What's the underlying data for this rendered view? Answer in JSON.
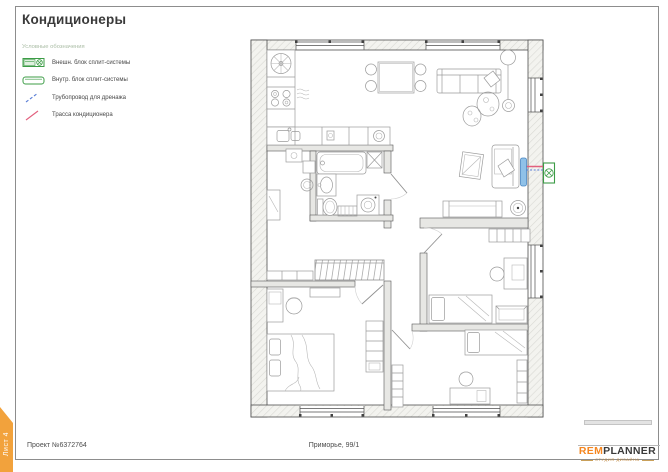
{
  "sheet": {
    "title": "Кондиционеры",
    "tab_label": "Лист 4",
    "footer": {
      "project": "Проект №6372764",
      "address": "Приморье, 99/1"
    },
    "logo": {
      "part1": "REM",
      "part2": "PLANNER",
      "subtitle": "студия дизайна"
    }
  },
  "legend": {
    "header": "Условные обозначения",
    "items": [
      {
        "icon": "outdoor-unit-icon",
        "label": "Внешн. блок сплит-системы"
      },
      {
        "icon": "indoor-unit-icon",
        "label": "Внутр. блок сплит-системы"
      },
      {
        "icon": "drain-pipe-icon",
        "label": "Трубопровод для дренажа"
      },
      {
        "icon": "ac-route-icon",
        "label": "Трасса кондиционера"
      }
    ]
  },
  "colors": {
    "accent_orange": "#F2A23C",
    "logo_orange": "#F5861F",
    "legend_green": "#3C9C46",
    "indoor_unit_blue": "#8FC1E8",
    "indoor_unit_border": "#4A86C2",
    "route_red": "#E2607E",
    "drain_blue": "#5B7FD6",
    "legend_header_gray_green": "#A9BCA4",
    "text_dark": "#3A3A3A"
  }
}
